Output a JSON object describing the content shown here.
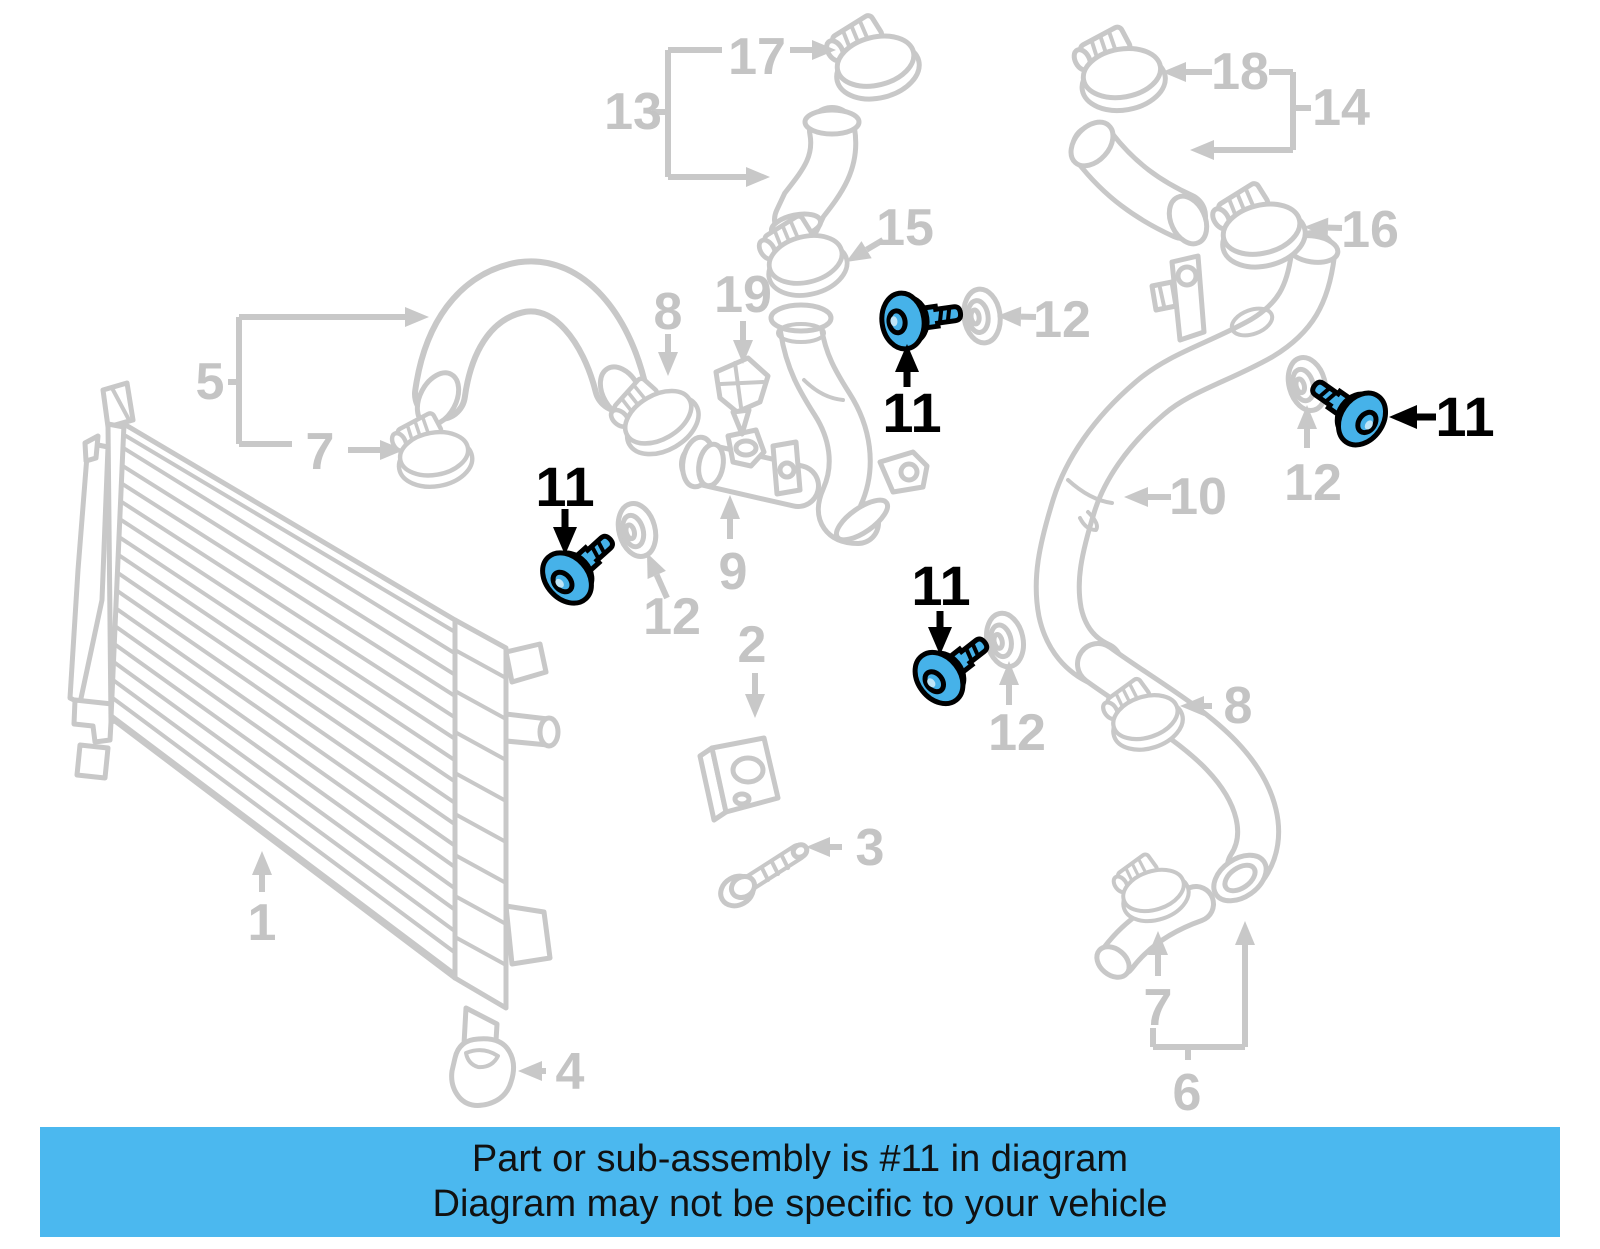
{
  "diagram": {
    "highlighted_part": "11",
    "banner": {
      "line1": "Part or sub-assembly is #11 in diagram",
      "line2": "Diagram may not be specific to your vehicle"
    },
    "colors": {
      "background": "#ffffff",
      "line_art": "#c8c8c8",
      "label_gray": "#c4c4c4",
      "highlight_fill": "#46b2e9",
      "highlight_outline": "#000000",
      "banner_bg": "#4bb8ef",
      "banner_text": "#111111"
    },
    "callouts": [
      {
        "label": "17",
        "x": 757,
        "y": 57,
        "highlight": false
      },
      {
        "label": "13",
        "x": 633,
        "y": 112,
        "highlight": false
      },
      {
        "label": "18",
        "x": 1240,
        "y": 72,
        "highlight": false
      },
      {
        "label": "14",
        "x": 1341,
        "y": 108,
        "highlight": false
      },
      {
        "label": "15",
        "x": 905,
        "y": 228,
        "highlight": false
      },
      {
        "label": "16",
        "x": 1370,
        "y": 230,
        "highlight": false
      },
      {
        "label": "8",
        "x": 668,
        "y": 312,
        "highlight": false
      },
      {
        "label": "19",
        "x": 743,
        "y": 295,
        "highlight": false
      },
      {
        "label": "12",
        "x": 1062,
        "y": 320,
        "highlight": false
      },
      {
        "label": "5",
        "x": 210,
        "y": 382,
        "highlight": false
      },
      {
        "label": "7",
        "x": 320,
        "y": 452,
        "highlight": false
      },
      {
        "label": "11",
        "x": 565,
        "y": 487,
        "highlight": true
      },
      {
        "label": "12",
        "x": 672,
        "y": 617,
        "highlight": false
      },
      {
        "label": "9",
        "x": 733,
        "y": 572,
        "highlight": false
      },
      {
        "label": "2",
        "x": 752,
        "y": 645,
        "highlight": false
      },
      {
        "label": "11",
        "x": 912,
        "y": 413,
        "highlight": true
      },
      {
        "label": "11",
        "x": 941,
        "y": 586,
        "highlight": true
      },
      {
        "label": "12",
        "x": 1017,
        "y": 733,
        "highlight": false
      },
      {
        "label": "10",
        "x": 1198,
        "y": 497,
        "highlight": false
      },
      {
        "label": "12",
        "x": 1313,
        "y": 483,
        "highlight": false
      },
      {
        "label": "11",
        "x": 1465,
        "y": 417,
        "highlight": true
      },
      {
        "label": "8",
        "x": 1238,
        "y": 706,
        "highlight": false
      },
      {
        "label": "3",
        "x": 870,
        "y": 848,
        "highlight": false
      },
      {
        "label": "1",
        "x": 262,
        "y": 923,
        "highlight": false
      },
      {
        "label": "4",
        "x": 570,
        "y": 1072,
        "highlight": false
      },
      {
        "label": "7",
        "x": 1158,
        "y": 1008,
        "highlight": false
      },
      {
        "label": "6",
        "x": 1187,
        "y": 1093,
        "highlight": false
      }
    ]
  }
}
